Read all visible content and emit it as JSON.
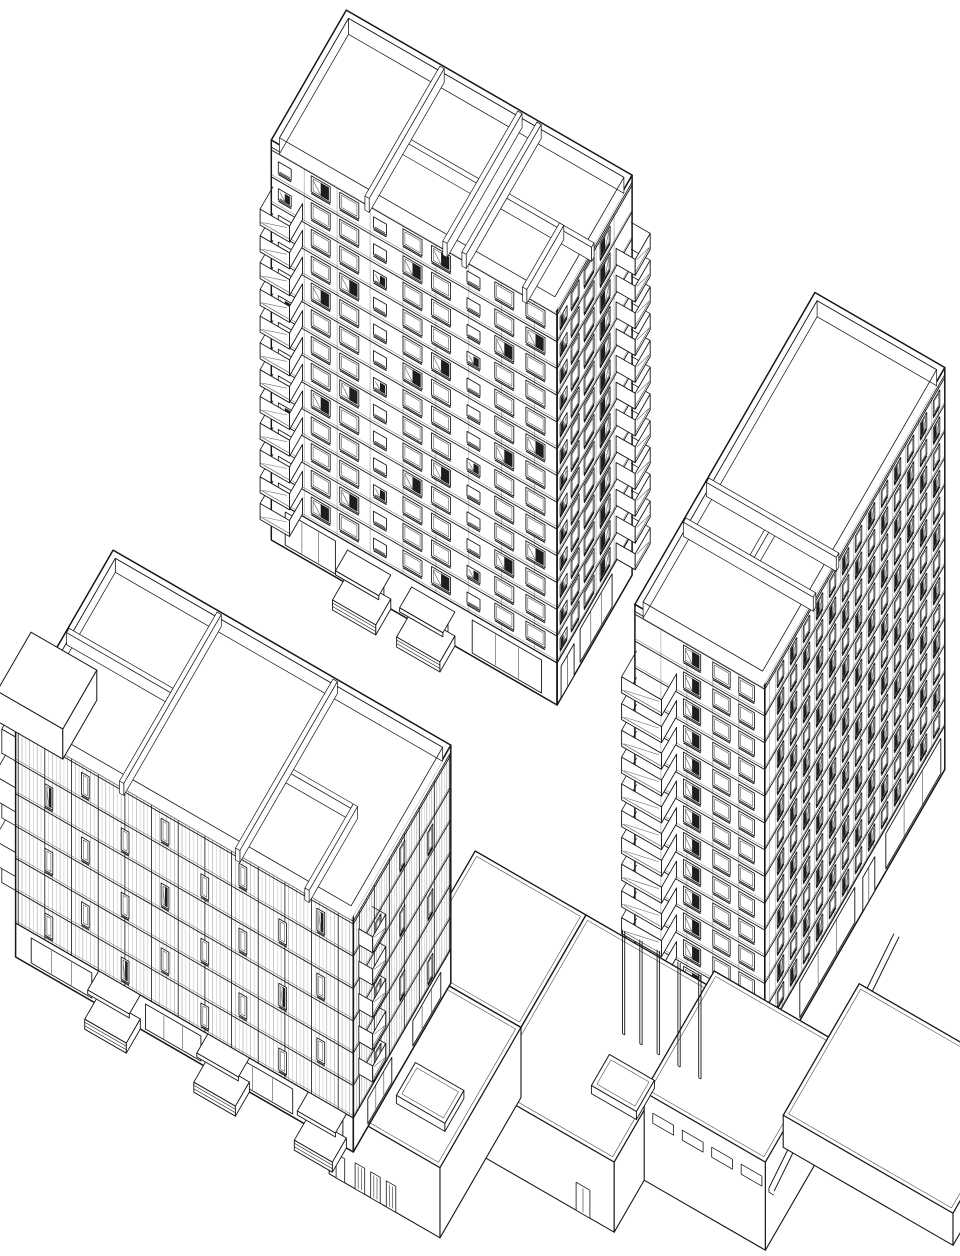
{
  "meta": {
    "drawing_type": "axonometric architectural line drawing",
    "subject": "three residential towers with balconies and a connecting low podium, black line work on white",
    "projection_label": "military axonometric 30/60"
  },
  "canvas": {
    "width": 960,
    "height": 1256,
    "background": "#ffffff"
  },
  "style": {
    "ink": "#161616",
    "soft": "#4e4e4e",
    "light": "#9b9b9b",
    "pale": "#c7c7c7",
    "dark_glass": "#1e1e1e",
    "mid_glass": "#707070",
    "bg": "#ffffff"
  },
  "projection": {
    "cos": 0.866,
    "sin": 0.5
  },
  "buildings": [
    {
      "id": "tower-north",
      "type": "tower",
      "origin": [
        505,
        182
      ],
      "w": 330,
      "d": 150,
      "h": 400,
      "ground_h": 42,
      "floors": 13,
      "parapet": {
        "inset": 6,
        "wall_h": 16,
        "t": 5
      },
      "partitions": [
        [
          "y",
          108,
          0,
          150
        ],
        [
          "x",
          78,
          108,
          198
        ],
        [
          "y",
          198,
          0,
          150
        ],
        [
          "y",
          220,
          0,
          150
        ],
        [
          "x",
          76,
          220,
          330
        ],
        [
          "y",
          290,
          76,
          150
        ]
      ],
      "faces": {
        "front": {
          "joint_step": 38,
          "win_h": 16,
          "dark_mod": 4,
          "cols": [
            [
              8,
              15,
              "s"
            ],
            [
              46,
              22,
              "w"
            ],
            [
              79,
              22,
              "w"
            ],
            [
              118,
              15,
              "s"
            ],
            [
              152,
              22,
              "w"
            ],
            [
              185,
              22,
              "w"
            ],
            [
              226,
              15,
              "s"
            ],
            [
              258,
              22,
              "w"
            ],
            [
              294,
              22,
              "w"
            ]
          ],
          "ground": {
            "panels": [
              [
                16,
                58
              ],
              [
                232,
                80
              ]
            ],
            "doors": [
              [
                96,
                34
              ],
              [
                170,
                34
              ]
            ]
          }
        },
        "right": {
          "joint_step": 36,
          "win_h": 16,
          "dark_mod": 3,
          "cols": [
            [
              44,
              20,
              "w"
            ],
            [
              76,
              20,
              "w"
            ],
            [
              106,
              16,
              "w"
            ],
            [
              130,
              14,
              "s"
            ]
          ],
          "ground": {
            "panels": [
              [
                40,
                64
              ]
            ],
            "doors": [
              [
                116,
                26
              ]
            ]
          }
        }
      },
      "balconies": [
        {
          "face": "front",
          "u": 2,
          "w": 34,
          "dep": 26,
          "from": 1,
          "to": 12
        },
        {
          "face": "right",
          "u": 2,
          "w": 30,
          "dep": 22,
          "from": 1,
          "to": 12
        }
      ],
      "stoops": [
        {
          "face": "front",
          "u": 88,
          "w": 50,
          "dep": 30
        },
        {
          "face": "front",
          "u": 162,
          "w": 50,
          "dep": 30
        }
      ]
    },
    {
      "id": "tower-east",
      "type": "tower",
      "origin": [
        1053,
        194
      ],
      "w": 150,
      "d": 360,
      "h": 402,
      "ground_h": 44,
      "floors": 13,
      "parapet": {
        "inset": 6,
        "wall_h": 16,
        "t": 5
      },
      "partitions": [
        [
          "x",
          212,
          0,
          150
        ],
        [
          "x",
          258,
          0,
          150
        ],
        [
          "y",
          74,
          212,
          258
        ]
      ],
      "faces": {
        "front": {
          "joint_step": 30,
          "win_h": 16,
          "dark_mod": 3,
          "cols": [
            [
              56,
              20,
              "w"
            ],
            [
              90,
              20,
              "w"
            ],
            [
              120,
              18,
              "w"
            ]
          ],
          "ground": {
            "panels": [],
            "doors": []
          }
        },
        "right": {
          "joint_step": 13,
          "win_h": 15,
          "dark_mod": 2,
          "cols": [
            [
              10,
              13,
              "w"
            ],
            [
              36,
              13,
              "w"
            ],
            [
              62,
              13,
              "w"
            ],
            [
              88,
              13,
              "w"
            ],
            [
              114,
              13,
              "w"
            ],
            [
              140,
              13,
              "w"
            ],
            [
              166,
              13,
              "w"
            ],
            [
              192,
              13,
              "w"
            ],
            [
              218,
              13,
              "w"
            ],
            [
              244,
              13,
              "w"
            ],
            [
              270,
              13,
              "w"
            ],
            [
              296,
              13,
              "w"
            ],
            [
              322,
              13,
              "w"
            ]
          ],
          "ground": {
            "panels": [
              [
                8,
                110
              ],
              [
                180,
                110
              ]
            ],
            "doors": [
              [
                140,
                24
              ]
            ]
          }
        }
      },
      "balconies": [
        {
          "face": "front",
          "u": 2,
          "w": 46,
          "dep": 30,
          "from": 1,
          "to": 12
        }
      ],
      "stoops": []
    },
    {
      "id": "podium",
      "type": "podium",
      "blocks": [
        {
          "x0": 872,
          "y0": 560,
          "x1": 1000,
          "y1": 690,
          "h": 70
        },
        {
          "x0": 1000,
          "y0": 560,
          "x1": 1148,
          "y1": 760,
          "h": 70,
          "door": [
            104,
            16
          ]
        },
        {
          "x0": 1148,
          "y0": 560,
          "x1": 1288,
          "y1": 700,
          "h": 88,
          "slits_front": 4,
          "slits_right": 2
        },
        {
          "x0": 872,
          "y0": 690,
          "x1": 1000,
          "y1": 852,
          "h": 70,
          "doors3": true
        }
      ],
      "skylights": [
        {
          "x0": 930,
          "y0": 780,
          "x1": 986,
          "y1": 818,
          "h": 8
        },
        {
          "x0": 1094,
          "y0": 676,
          "x1": 1146,
          "y1": 712,
          "h": 8
        }
      ],
      "ramp": {
        "x": 1262,
        "y0": 398,
        "y1": 648,
        "z0": 42,
        "z1": 4,
        "t": 6
      },
      "terrace": {
        "x0": 1252,
        "y0": 450,
        "x1": 1448,
        "y1": 602,
        "h": 32
      },
      "stilts": {
        "y": 584,
        "xs": [
          1056,
          1076,
          1096,
          1120,
          1144
        ],
        "h": 104
      }
    },
    {
      "id": "slab-west",
      "type": "tower",
      "origin": [
        492,
        626
      ],
      "w": 390,
      "d": 195,
      "h": 238,
      "ground_h": 34,
      "floors": 6,
      "parapet": {
        "inset": 6,
        "wall_h": 14,
        "t": 5
      },
      "partitions": [
        [
          "y",
          120,
          0,
          195
        ],
        [
          "x",
          88,
          0,
          120
        ],
        [
          "y",
          254,
          0,
          195
        ],
        [
          "x",
          98,
          254,
          334
        ],
        [
          "y",
          334,
          98,
          195
        ]
      ],
      "faces": {
        "front": {
          "stripes": {
            "step": 4.4,
            "accent_every": 7
          },
          "win_h": 22,
          "dark_mod": 5,
          "stagger": true,
          "cols": [
            [
              34,
              9,
              "n"
            ],
            [
              76,
              9,
              "n"
            ],
            [
              122,
              9,
              "n"
            ],
            [
              168,
              9,
              "n"
            ],
            [
              214,
              9,
              "n"
            ],
            [
              258,
              9,
              "n"
            ],
            [
              304,
              9,
              "n"
            ],
            [
              348,
              9,
              "n"
            ]
          ],
          "ground": {
            "panels": [
              [
                18,
                70
              ],
              [
                150,
                64
              ],
              [
                250,
                70
              ],
              [
                338,
                40
              ]
            ],
            "doors": []
          }
        },
        "right": {
          "stripes": {
            "step": 5,
            "accent_every": 6
          },
          "win_h": 22,
          "dark_mod": 4,
          "stagger": true,
          "cols": [
            [
              36,
              10,
              "n"
            ],
            [
              92,
              10,
              "n"
            ],
            [
              140,
              10,
              "n"
            ]
          ],
          "ground": {
            "panels": [
              [
                20,
                56
              ],
              [
                118,
                48
              ]
            ],
            "doors": []
          }
        }
      },
      "balconies": [
        {
          "face": "right",
          "u": 158,
          "w": 26,
          "dep": 16,
          "from": 2,
          "to": 6
        }
      ],
      "stoops": [
        {
          "face": "front",
          "u": 96,
          "w": 48,
          "dep": 28
        },
        {
          "face": "front",
          "u": 222,
          "w": 48,
          "dep": 28
        },
        {
          "face": "front",
          "u": 338,
          "w": 44,
          "dep": 28
        }
      ],
      "edge_balconies": {
        "x0": 464,
        "x1": 494,
        "y0": 752,
        "y1": 800,
        "from": 1,
        "to": 5
      },
      "roof_box": {
        "x0": 470,
        "x1": 546,
        "y0": 752,
        "y1": 820,
        "dz": 16
      }
    }
  ]
}
